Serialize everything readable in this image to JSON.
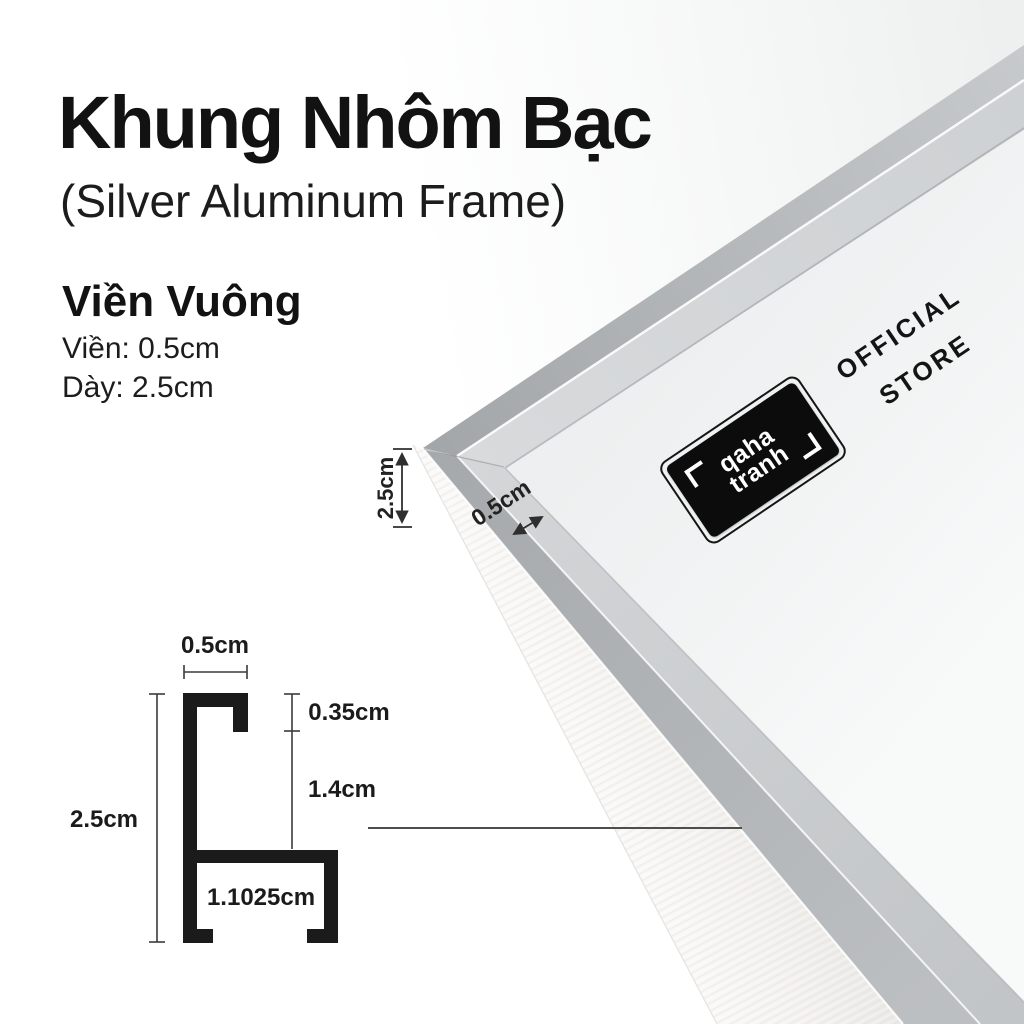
{
  "header": {
    "title": "Khung Nhôm Bạc",
    "subtitle": "(Silver Aluminum Frame)"
  },
  "specs": {
    "heading": "Viền Vuông",
    "border_line": "Viền: 0.5cm",
    "thickness_line": "Dày: 2.5cm"
  },
  "photo": {
    "brand_line1": "qaha",
    "brand_line2": "tranh",
    "store_line1": "OFFICIAL",
    "store_line2": "STORE",
    "thickness_label": "2.5cm",
    "face_label": "0.5cm"
  },
  "diagram": {
    "top_width": "0.5cm",
    "total_height": "2.5cm",
    "lip_depth": "0.35cm",
    "inner_depth": "1.4cm",
    "bottom_width": "1.1025cm"
  },
  "colors": {
    "ink": "#141414",
    "frame_face": "#aeb2b4",
    "frame_bevel": "#d3d5d7",
    "frame_side": "#f4f3f1",
    "mat": "#f2f3f4"
  }
}
